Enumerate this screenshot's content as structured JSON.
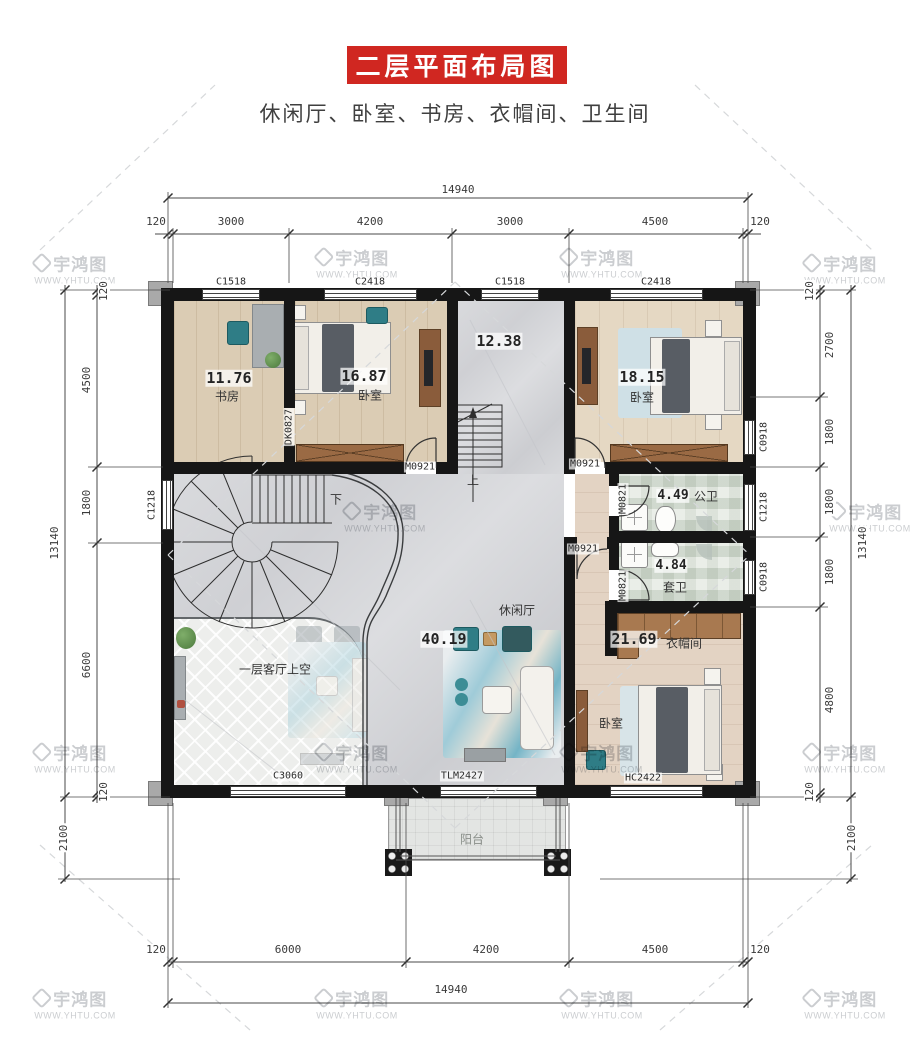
{
  "header": {
    "title": "二层平面布局图",
    "subtitle": "休闲厅、卧室、书房、衣帽间、卫生间"
  },
  "watermark": {
    "brand": "宇鸿图",
    "url": "WWW.YHTU.COM"
  },
  "rooms": {
    "study": {
      "area": "11.76",
      "name": "书房"
    },
    "bedroom1": {
      "area": "16.87",
      "name": "卧室"
    },
    "stair_hall": {
      "area": "12.38"
    },
    "bedroom2": {
      "area": "18.15",
      "name": "卧室"
    },
    "bath_public": {
      "area": "4.49",
      "name": "公卫"
    },
    "bath_ensuite": {
      "area": "4.84",
      "name": "套卫"
    },
    "cloakroom": {
      "area": "21.69",
      "name": "衣帽间"
    },
    "lounge": {
      "area": "40.19",
      "name": "休闲厅"
    },
    "bedroom3": {
      "name": "卧室"
    },
    "void": {
      "name": "一层客厅上空"
    },
    "balcony": {
      "name": "阳台"
    }
  },
  "stairs": {
    "up": "上",
    "down": "下"
  },
  "openings": {
    "top_windows": [
      "C1518",
      "C2418",
      "C1518",
      "C2418"
    ],
    "left_windows": [
      "C1218"
    ],
    "right_windows": [
      "C0918",
      "C1218",
      "C0918"
    ],
    "bottom_openings": [
      "C3060",
      "TLM2427",
      "HC2422"
    ],
    "doors": {
      "bedroom1": "M0921",
      "bedroom2": "M0921",
      "suite": "M0921",
      "bath_public": "M0821",
      "bath_ensuite": "M0821",
      "study_pass": "DK0827"
    }
  },
  "dimensions": {
    "top": {
      "total": "14940",
      "segments": [
        "120",
        "3000",
        "4200",
        "3000",
        "4500",
        "120"
      ]
    },
    "bottom": {
      "total": "14940",
      "segments": [
        "120",
        "6000",
        "4200",
        "4500",
        "120"
      ]
    },
    "left": {
      "total": "13140",
      "segments": [
        "120",
        "4500",
        "1800",
        "6600",
        "120",
        "2100"
      ]
    },
    "right": {
      "total": "13140",
      "segments": [
        "120",
        "2700",
        "1800",
        "1800",
        "1800",
        "4800",
        "120",
        "2100"
      ]
    }
  }
}
